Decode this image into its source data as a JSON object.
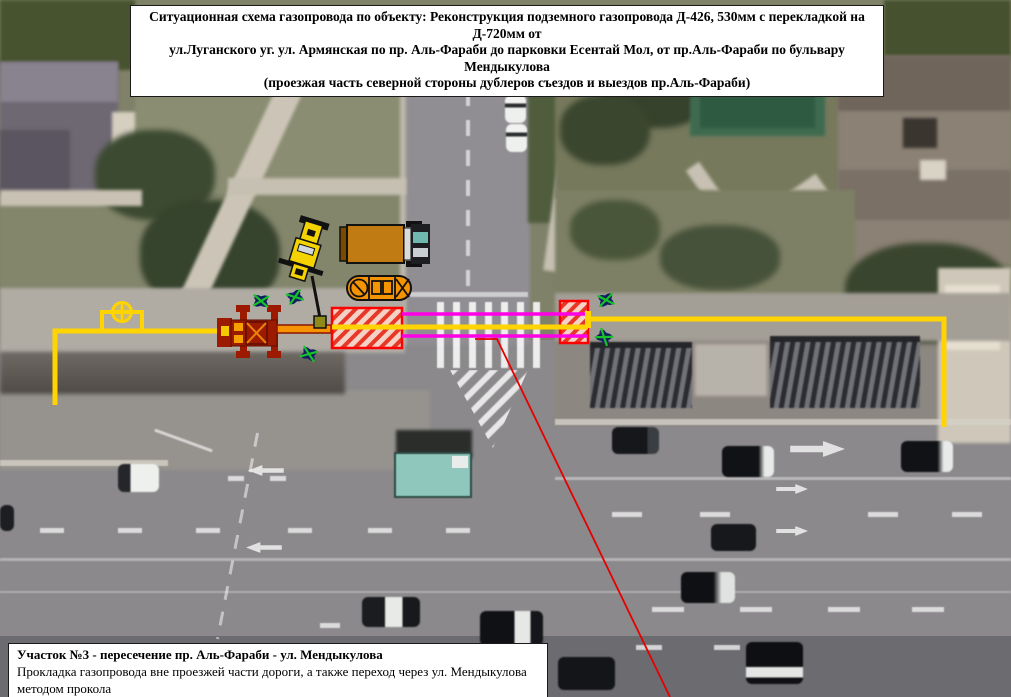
{
  "header": {
    "title_lines": [
      "Ситуационная схема газопровода по объекту: Реконструкция подземного газопровода Д-426, 530мм с перекладкой на Д-720мм от",
      "ул.Луганского уг. ул. Армянская по пр. Аль-Фараби до парковки Есентай Мол, от пр.Аль-Фараби по бульвару Мендыкулова",
      "(проезжая часть северной стороны дублеров съездов и выездов пр.Аль-Фараби)"
    ]
  },
  "footer": {
    "section_title": "Участок №3 - пересечение пр. Аль-Фараби - ул. Мендыкулова",
    "section_description": "Прокладка газопровода вне проезжей части дороги, а также переход через ул. Мендыкулова методом прокола"
  },
  "colors": {
    "pipeline_yellow": "#FFD400",
    "crossing_casing_magenta": "#FF00E6",
    "excavation_pit_red": "#FF0000",
    "leader_line_red": "#E60000",
    "boring_machine_dark_red": "#9C1A00",
    "equipment_orange": "#F59300",
    "crane_yellow": "#F5D300",
    "tree_green": "#17C229",
    "tree_navy": "#16246B"
  },
  "icons": {
    "valve": "circle-with-cross",
    "tree": "green-cross-on-navy-petals",
    "excavation_pit": "red-diagonal-hatch-rectangle",
    "crossing": "double-magenta-casing-lines"
  }
}
